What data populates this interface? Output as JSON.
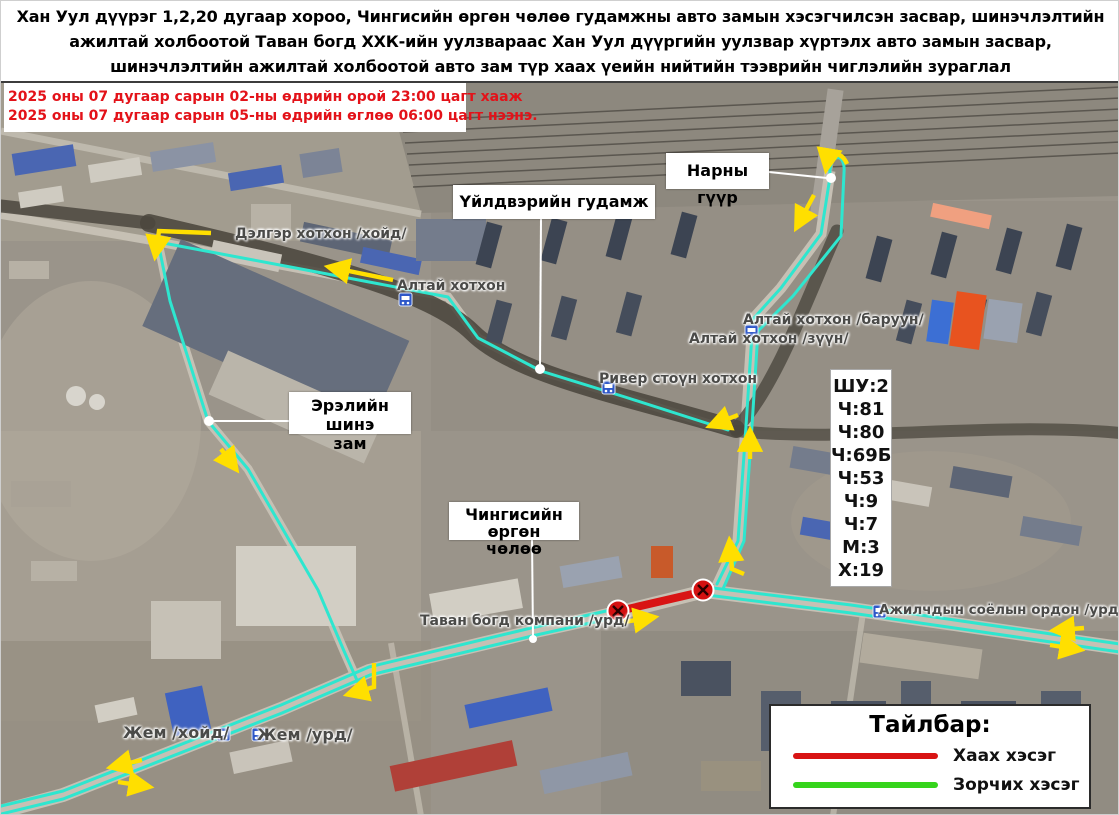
{
  "title": {
    "lines": [
      "Хан Уул дүүрэг 1,2,20 дугаар хороо, Чингисийн өргөн чөлөө гудамжны авто замын хэсэгчилсэн засвар, шинэчлэлтийн",
      "ажилтай холбоотой Таван богд ХХК-ийн уулзвараас Хан Уул дүүргийн уулзвар хүртэлх авто замын засвар,",
      "шинэчлэлтийн ажилтай холбоотой авто зам түр хаах үеийн нийтийн тээврийн чиглэлийн зураглал"
    ]
  },
  "notice": {
    "lines": [
      "2025 оны 07 дугаар сарын 02-ны өдрийн орой 23:00 цагт хааж",
      "2025 оны 07 дугаар сарын 05-ны өдрийн өглөө 06:00 цагт нээнэ."
    ]
  },
  "callouts": {
    "narny_guur": {
      "text": "Нарны гүүр"
    },
    "uildveriin": {
      "text": "Үйлдвэрийн гудамж"
    },
    "ereliin": {
      "line1": "Эрэлийн шинэ",
      "line2": "зам"
    },
    "chinggis": {
      "line1": "Чингисийн өргөн",
      "line2": "чөлөө"
    }
  },
  "map_labels": {
    "delger": "Дэлгэр хотхон /хойд/",
    "altai": "Алтай хотхон",
    "altai_baruun": "Алтай хотхон /баруун/",
    "altai_zuun": "Алтай хотхон /зүүн/",
    "river_stone": "Ривер стоүн хотхон",
    "tavan_bogd": "Таван богд компани /урд/",
    "ajilchdyn": "Ажилчдын соёлын ордон /урд/",
    "jem_khoid": "Жем /хойд/",
    "jem_urd": "Жем /урд/"
  },
  "bus_routes": {
    "items": [
      "ШУ:2",
      "Ч:81",
      "Ч:80",
      "Ч:69Б",
      "Ч:53",
      "Ч:9",
      "Ч:7",
      "М:3",
      "Х:19"
    ]
  },
  "legend": {
    "title": "Тайлбар:",
    "closed_label": "Хаах хэсэг",
    "open_label": "Зорчих хэсэг"
  },
  "colors": {
    "route_open": "#2ee6cf",
    "route_closed": "#d81414",
    "legend_open": "#35d41c",
    "arrow": "#ffdf00",
    "notice_text": "#e31219"
  }
}
